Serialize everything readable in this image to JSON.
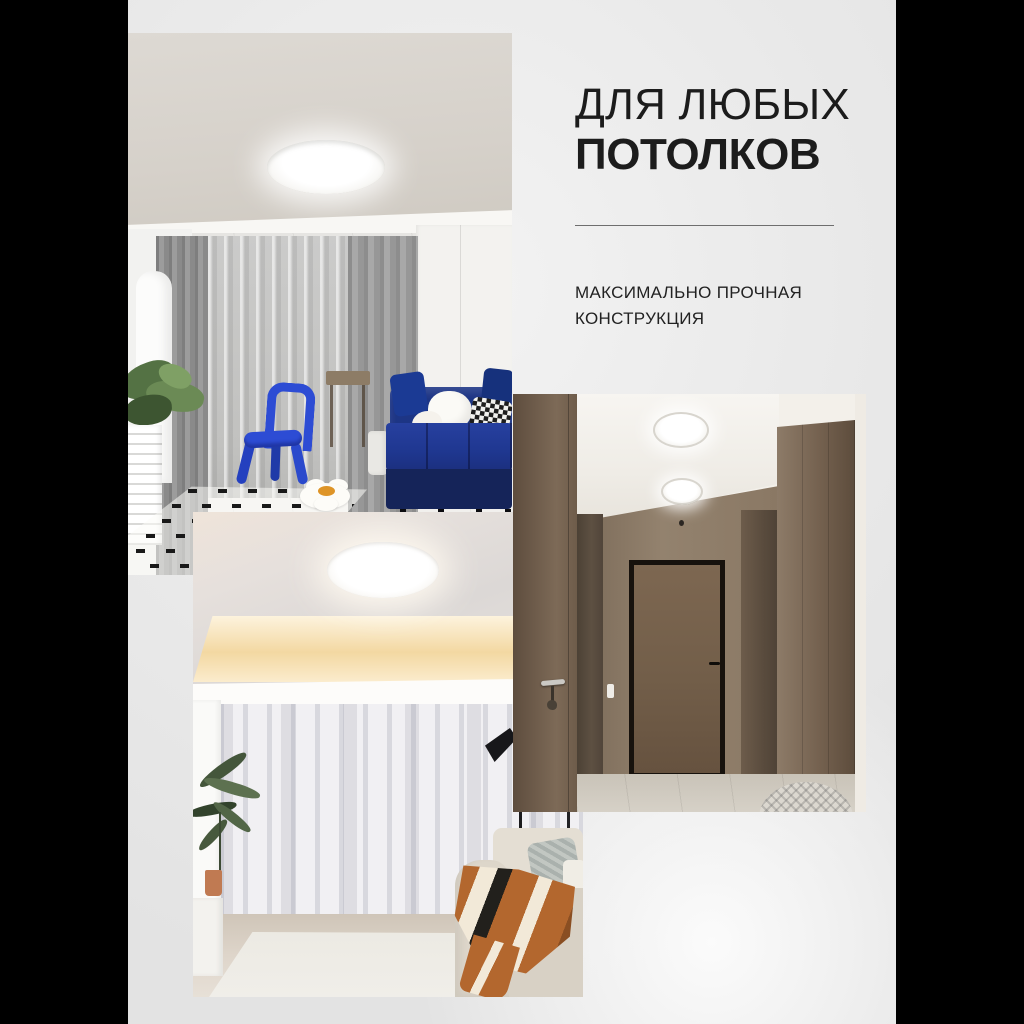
{
  "card": {
    "type": "marketplace-product-infographic",
    "headline": {
      "line1": "ДЛЯ ЛЮБЫХ",
      "line2": "ПОТОЛКОВ"
    },
    "subheadline": {
      "line1": "МАКСИМАЛЬНО ПРОЧНАЯ",
      "line2": "КОНСТРУКЦИЯ"
    }
  },
  "photos": {
    "living_room": {
      "name": "living-room-with-round-led-ceiling-light",
      "features": [
        "round-white-ceiling-lamp",
        "gray-curtains",
        "navy-blue-sofa",
        "blue-kids-chair",
        "black-dash-rug",
        "flower-cushion",
        "plant",
        "air-conditioner"
      ]
    },
    "white_room": {
      "name": "room-with-cove-lit-ceiling-and-round-light",
      "features": [
        "round-white-ceiling-lamp",
        "warm-cove-lighting",
        "white-curtains",
        "palm-plant",
        "beige-sofa-with-orange-blanket",
        "black-floor-lamp"
      ]
    },
    "hallway": {
      "name": "wood-panel-hallway-with-two-round-ceiling-lights",
      "features": [
        "two-round-white-ceiling-lamps",
        "wood-doors",
        "black-framed-door",
        "door-handle-with-keys",
        "woven-pouf"
      ]
    }
  },
  "colors": {
    "letterbox": "#000000",
    "card_background": "#e9e9e9",
    "text": "#1c1c1c",
    "divider": "#6e6e6e",
    "sofa_navy_blue": "#1d3585",
    "chair_blue": "#2d4cd4",
    "blanket_orange": "#b3672e",
    "hallway_wood_brown": "#7b6a58",
    "cove_glow_warm": "#f3d8a2"
  }
}
